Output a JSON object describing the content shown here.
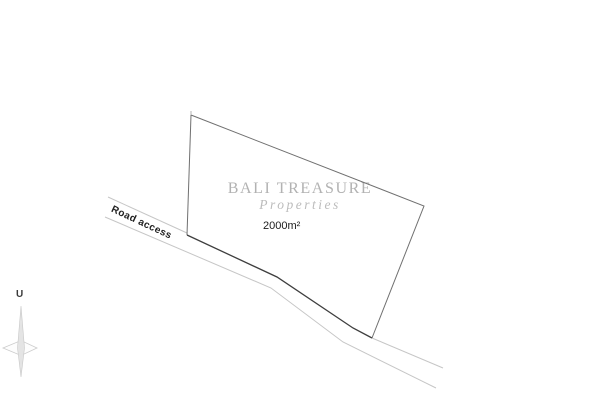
{
  "watermark": {
    "brand": "BALI TREASURE",
    "subtitle": "Properties"
  },
  "plot": {
    "area_label": "2000m²"
  },
  "road": {
    "label": "Road access"
  },
  "compass": {
    "north_label": "U"
  },
  "colors": {
    "background": "#ffffff",
    "parcel_edge": "#707070",
    "parcel_road_edge": "#3e3e3e",
    "road_line": "#c6c6c6",
    "watermark_text": "#b2b2b2",
    "label_text": "#1c1c1c",
    "compass_star_fill": "#e4e4e4",
    "compass_star_stroke": "#c8c8c8"
  }
}
